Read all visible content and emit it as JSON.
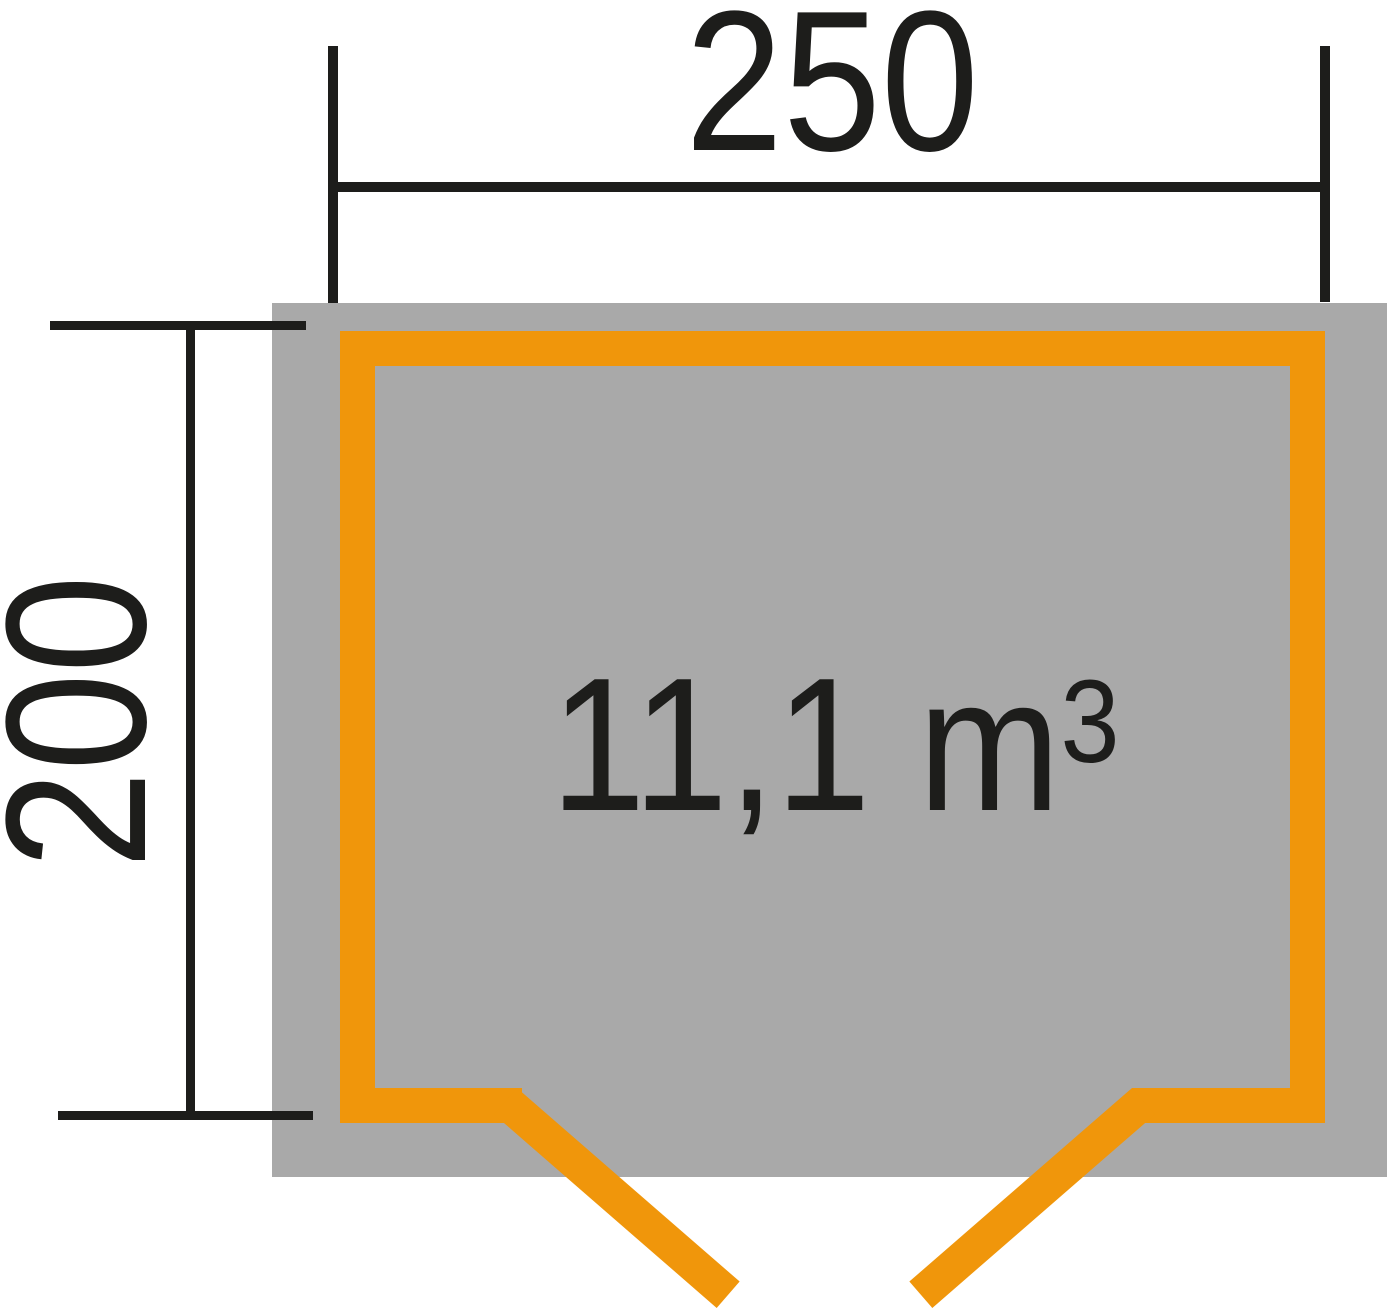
{
  "diagram": {
    "type": "shed-floorplan-dimension-drawing",
    "width_label": "250",
    "depth_label": "200",
    "volume": {
      "value": "11,1 m",
      "superscript": "3"
    },
    "colors": {
      "wall_orange": "#f0960b",
      "slab_gray": "#a9a9a9",
      "line_black": "#1d1d1b",
      "background": "#ffffff"
    }
  }
}
